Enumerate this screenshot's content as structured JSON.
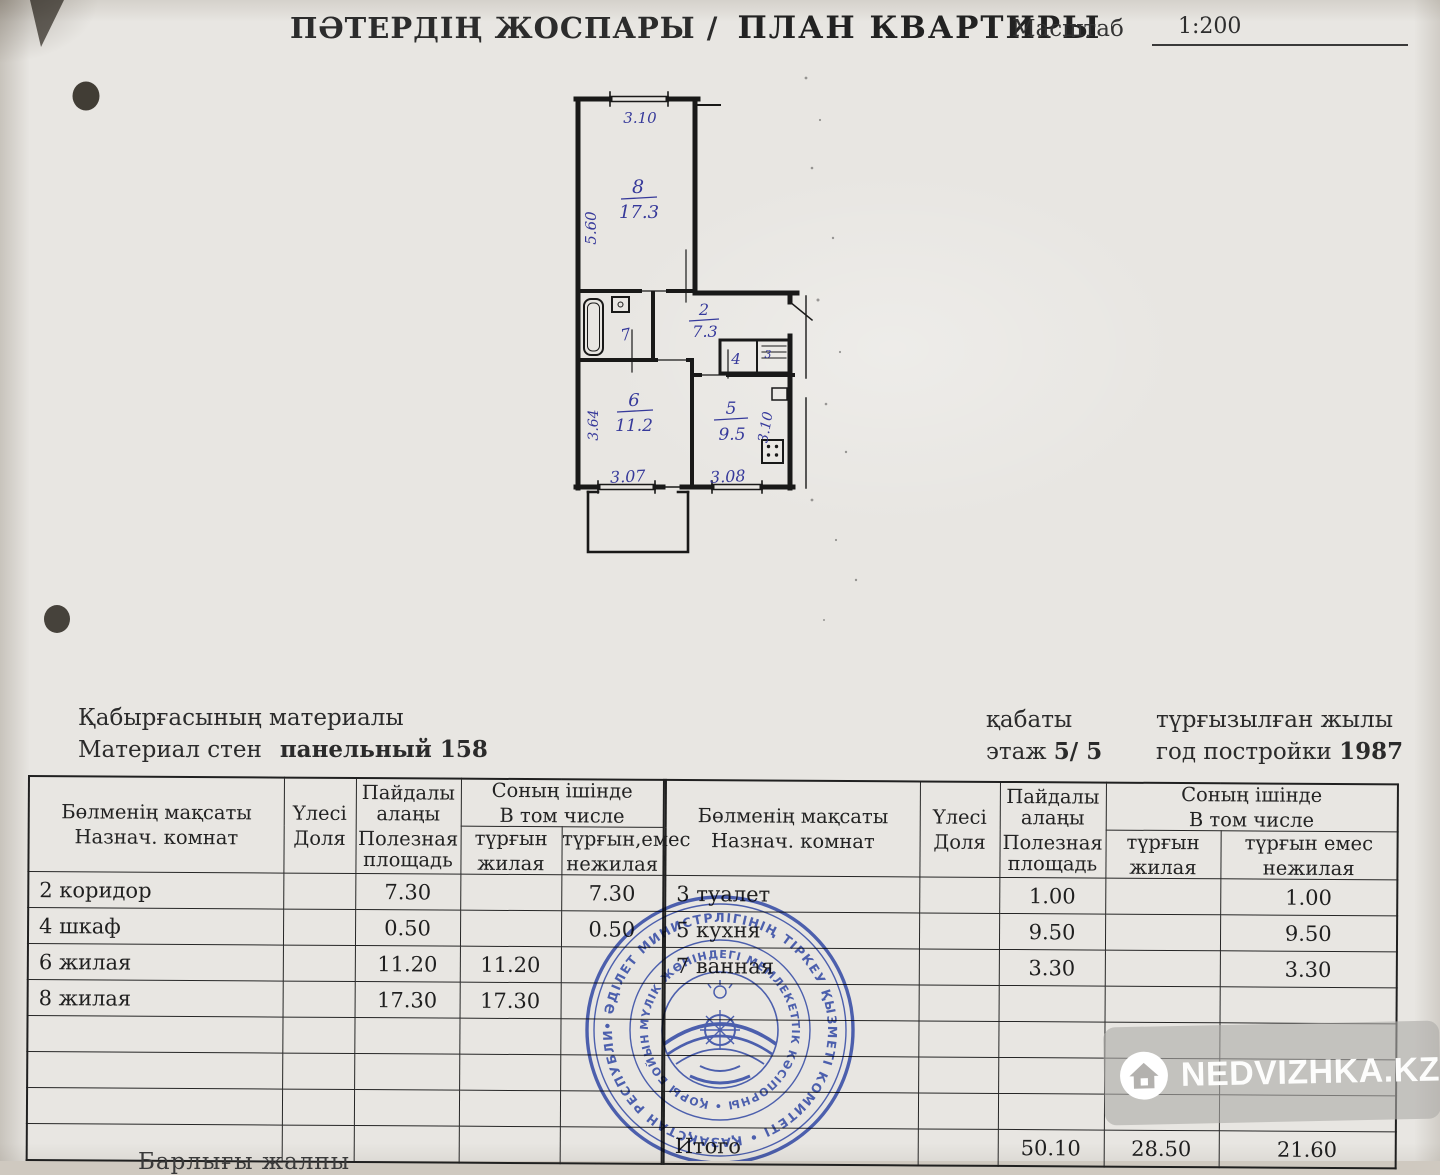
{
  "colors": {
    "paper": "#e8e6e2",
    "ink": "#262626",
    "handwriting_blue": "#3b3fae",
    "stamp_blue": "#2e49b6",
    "watermark_plate": "#adaba8",
    "watermark_text": "#fdfdfc"
  },
  "header": {
    "title_kk": "ПӘТЕРДІҢ ЖОСПАРЫ /",
    "title_ru": "ПЛАН КВАРТИРЫ",
    "scale_label": "Масштаб",
    "scale_value": "1:200"
  },
  "plan": {
    "rooms": {
      "room8": {
        "num": "8",
        "area": "17.3"
      },
      "room6": {
        "num": "6",
        "area": "11.2"
      },
      "kitchen": {
        "num": "5",
        "area": "9.5"
      },
      "corridor": {
        "num": "2",
        "area": "7.3"
      },
      "bathroom": {
        "num": "7"
      },
      "closet4": {
        "num": "4"
      },
      "closet3": {
        "num": "3"
      }
    },
    "dims": {
      "room8_top": "3.10",
      "room8_left": "5.60",
      "room6_left": "3.64",
      "room6_bottom": "3.07",
      "kitchen_bottom": "3.08",
      "kitchen_right": "3.10"
    }
  },
  "info": {
    "wall_kk": "Қабырғасының материалы",
    "wall_ru": "Материал стен",
    "wall_value": "панельный  158",
    "floor_kk": "қабаты",
    "floor_ru": "этаж",
    "floor_value": "5/ 5",
    "year_kk": "түрғызылған жылы",
    "year_ru": "год постройки",
    "year_value": "1987"
  },
  "table": {
    "headers": {
      "purpose_kk": "Бөлменің мақсаты",
      "purpose_ru": "Назнач. комнат",
      "share_kk": "Үлесі",
      "share_ru": "Доля",
      "useful_kk": "Пайдалы алаңы",
      "useful_ru": "Полезная площадь",
      "incl_kk": "Соның ішінде",
      "incl_ru": "В том числе",
      "living_kk": "түрғын",
      "living_ru": "жилая",
      "nonliving_kk_left": "түрғын,емес",
      "nonliving_kk_right": "түрғын емес",
      "nonliving_ru": "нежилая"
    },
    "left_rows": [
      [
        "2 коридор",
        "",
        "7.30",
        "",
        "7.30"
      ],
      [
        "4 шкаф",
        "",
        "0.50",
        "",
        "0.50"
      ],
      [
        "6 жилая",
        "",
        "11.20",
        "11.20",
        ""
      ],
      [
        "8 жилая",
        "",
        "17.30",
        "17.30",
        ""
      ],
      [
        "",
        "",
        "",
        "",
        ""
      ],
      [
        "",
        "",
        "",
        "",
        ""
      ],
      [
        "",
        "",
        "",
        "",
        ""
      ],
      [
        "",
        "",
        "",
        "",
        ""
      ]
    ],
    "right_rows": [
      [
        "3 туалет",
        "",
        "1.00",
        "",
        "1.00"
      ],
      [
        "5 кухня",
        "",
        "9.50",
        "",
        "9.50"
      ],
      [
        "7 ванная",
        "",
        "3.30",
        "",
        "3.30"
      ],
      [
        "",
        "",
        "",
        "",
        ""
      ],
      [
        "",
        "",
        "",
        "",
        ""
      ],
      [
        "",
        "",
        "",
        "",
        ""
      ],
      [
        "",
        "",
        "",
        "",
        ""
      ],
      [
        "Итого",
        "",
        "50.10",
        "28.50",
        "21.60"
      ]
    ]
  },
  "stamp": {
    "outer_text": "• ӘДІЛЕТ МИНИСТРЛІГІНІҢ ТІРКЕУ ҚЫЗМЕТІ КОМИТЕТІ • ҚАЗАҚСТАН РЕСПУБЛИКАСЫ",
    "inner_text": "МҮЛІК ЖӨНІНДЕГІ МЕМЛЕКЕТТІК КӘСІПОРНЫ • ҚОРЫ БОЙЫНША"
  },
  "watermark": {
    "text": "NEDVIZHKA.KZ"
  },
  "footer": {
    "partial_text": "Барлығы жалпы"
  }
}
